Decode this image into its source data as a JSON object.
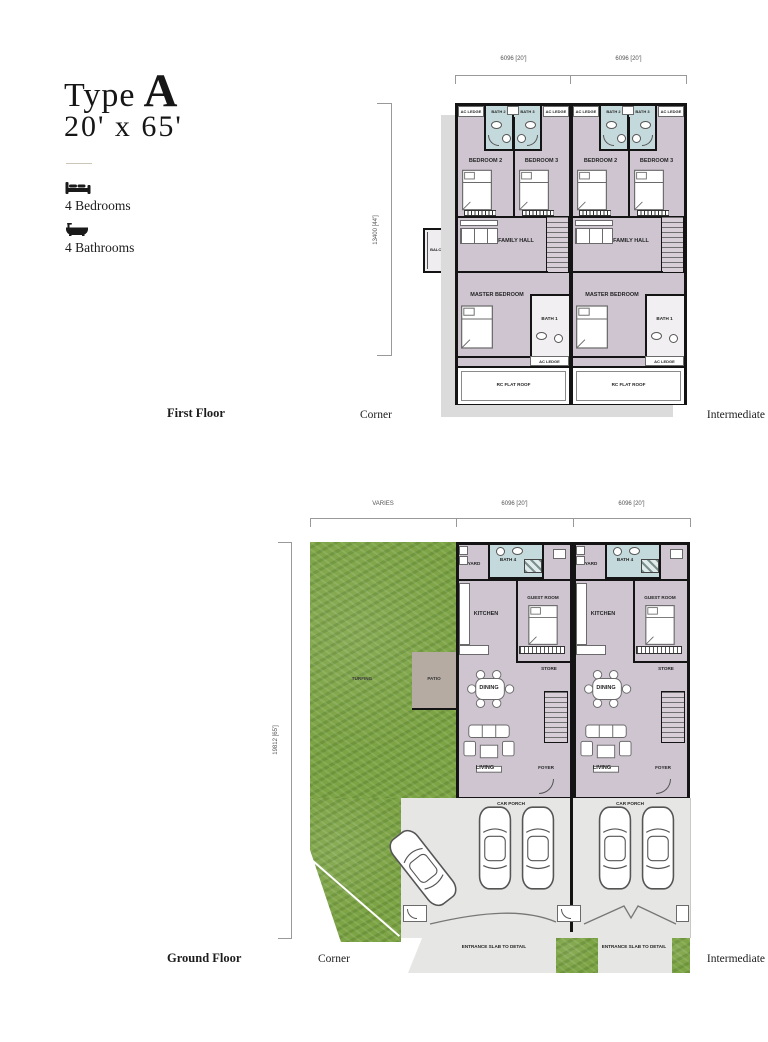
{
  "header": {
    "type_word": "Type",
    "type_letter": "A",
    "size": "20' x 65'",
    "bedrooms": "4 Bedrooms",
    "bathrooms": "4 Bathrooms"
  },
  "first_floor": {
    "title": "First Floor",
    "corner": "Corner",
    "intermediate": "Intermediate",
    "dim_unit_width": "6096 [20']",
    "dim_height": "13400 [44']",
    "rooms": {
      "ac_ledge": "AC LEDGE",
      "bath2": "BATH 2",
      "bath3": "BATH 3",
      "bedroom2": "BEDROOM 2",
      "bedroom3": "BEDROOM 3",
      "family_hall": "FAMILY HALL",
      "balcony": "BALCONY",
      "master_bedroom": "MASTER BEDROOM",
      "bath1": "BATH 1",
      "rc_flat_roof": "RC FLAT ROOF"
    }
  },
  "ground_floor": {
    "title": "Ground Floor",
    "corner": "Corner",
    "intermediate": "Intermediate",
    "dim_varies": "VARIES",
    "dim_unit_width": "6096 [20']",
    "dim_height": "19812 [65']",
    "rooms": {
      "turfing": "TURFING",
      "patio": "PATIO",
      "yard": "YARD",
      "bath4": "BATH 4",
      "kitchen": "KITCHEN",
      "guest_room": "GUEST ROOM",
      "store": "STORE",
      "dining": "DINING",
      "living": "LIVING",
      "foyer": "FOYER",
      "car_porch": "CAR PORCH",
      "entrance_slab": "ENTRANCE SLAB TO DETAIL"
    }
  },
  "colors": {
    "room_fill": "#cec5d1",
    "bath_fill": "#c4d9db",
    "grass": "#7ca344",
    "patio": "#b5aba3",
    "porch": "#e6e6e4",
    "wall": "#141414"
  }
}
